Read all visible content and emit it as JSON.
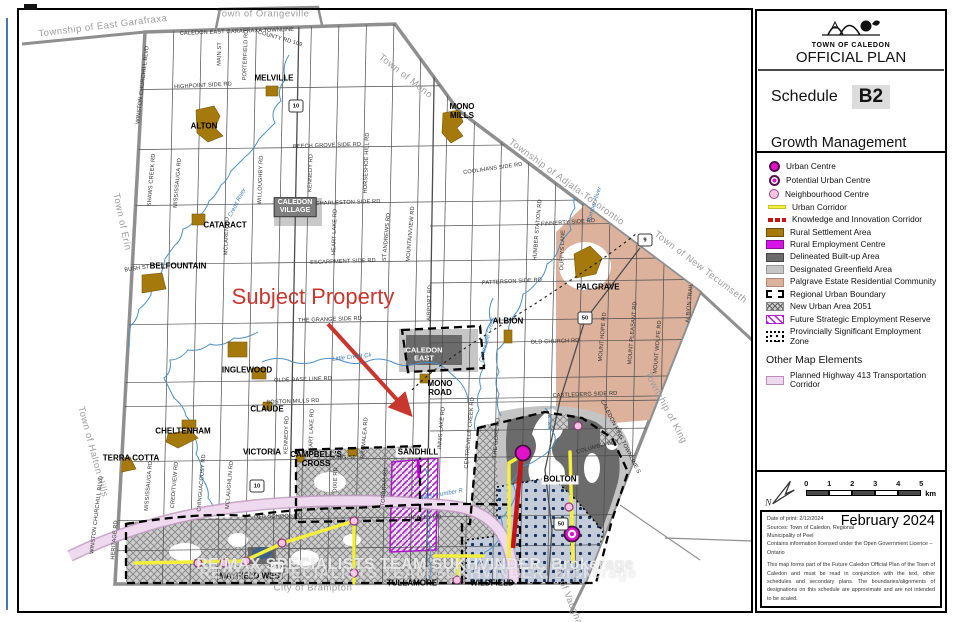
{
  "title_block": {
    "org": "TOWN OF CALEDON",
    "plan": "OFFICIAL PLAN",
    "schedule_label": "Schedule",
    "schedule_code": "B2",
    "subtitle": "Growth Management"
  },
  "legend": {
    "items": [
      {
        "label": "Urban Centre",
        "swatch": "uc"
      },
      {
        "label": "Potential Urban Centre",
        "swatch": "puc"
      },
      {
        "label": "Neighbourhood Centre",
        "swatch": "nc"
      },
      {
        "label": "Urban Corridor",
        "swatch": "ycorr"
      },
      {
        "label": "Knowledge and Innovation Corridor",
        "swatch": "kic"
      },
      {
        "label": "Rural Settlement Area",
        "swatch": "rsa"
      },
      {
        "label": "Rural Employment Centre",
        "swatch": "rec"
      },
      {
        "label": "Delineated Built-up Area",
        "swatch": "dba"
      },
      {
        "label": "Designated Greenfield Area",
        "swatch": "dga"
      },
      {
        "label": "Palgrave Estate Residential Community",
        "swatch": "perc"
      },
      {
        "label": "Regional Urban Boundary",
        "swatch": "rub"
      },
      {
        "label": "New Urban Area 2051",
        "swatch": "nua"
      },
      {
        "label": "Future Strategic Employment Reserve",
        "swatch": "fser"
      },
      {
        "label": "Provincially Significant Employment Zone",
        "swatch": "psez"
      }
    ],
    "other_header": "Other Map Elements",
    "other_items": [
      {
        "label": "Planned Highway 413 Transportation Corridor",
        "swatch": "h413"
      }
    ]
  },
  "scale": {
    "ticks": [
      "0",
      "1",
      "2",
      "3",
      "4",
      "5"
    ],
    "unit": "km",
    "north": "N"
  },
  "notes": {
    "month": "February 2024",
    "date_of_print": "Date of print: 2/12/2024",
    "sources": "Sources: Town of Caledon, Regional Municipality of Peel",
    "licence": "Contains information licensed under the Open Government Licence – Ontario",
    "disclaimer": "This map forms part of the Future Caledon Official Plan of the Town of Caledon and must be read in conjunction with the text, other schedules and secondary plans. The boundaries/alignments of designations on this schedule are approximate and are not intended to be scaled."
  },
  "map": {
    "subject_property": {
      "text": "Subject Property",
      "x": 313,
      "y": 297
    },
    "watermark": "RE/MAX SPECIALISTS TEAM SUKHVINDER, Brokerage",
    "colors": {
      "urban_centre": "#e013c8",
      "neighbourhood": "#f6c3e3",
      "rural_settlement": "#a5790c",
      "built_up": "#6b6b6b",
      "greenfield": "#c6c6c6",
      "palgrave_estate": "#dcb29c",
      "corridor_yellow": "#f3ef3c",
      "corridor_red": "#c41414",
      "hwy413_pink": "#eed9ee",
      "water": "#4d8fc4",
      "subject_red": "#c8372d"
    },
    "labels": [
      [
        "Township of East Garafraxa",
        103,
        27,
        -7,
        "bound"
      ],
      [
        "Town of Orangeville",
        263,
        15,
        0,
        "bound"
      ],
      [
        "Town of Mono",
        405,
        77,
        38,
        "bound"
      ],
      [
        "Township of Adjala-Tosorontio",
        566,
        183,
        36,
        "bound"
      ],
      [
        "Town of New Tecumseth",
        700,
        268,
        37,
        "bound"
      ],
      [
        "Township of King",
        665,
        408,
        62,
        "bound"
      ],
      [
        "City of Vaughan",
        567,
        596,
        68,
        "bound"
      ],
      [
        "Town of Erin",
        121,
        222,
        78,
        "bound"
      ],
      [
        "Town of Halton Hills",
        92,
        452,
        75,
        "bound"
      ],
      [
        "City of Brampton",
        313,
        589,
        0,
        "bound"
      ],
      [
        "ALTON",
        204,
        127,
        0,
        "set"
      ],
      [
        "MELVILLE",
        274,
        79,
        0,
        "set"
      ],
      [
        "MONO\nMILLS",
        462,
        112,
        0,
        "set"
      ],
      [
        "CATARACT",
        225,
        226,
        0,
        "set"
      ],
      [
        "BELFOUNTAIN",
        178,
        267,
        0,
        "set"
      ],
      [
        "INGLEWOOD",
        247,
        371,
        0,
        "set"
      ],
      [
        "CLAUDE",
        267,
        410,
        0,
        "set"
      ],
      [
        "CHELTENHAM",
        183,
        432,
        0,
        "set"
      ],
      [
        "TERRA COTTA",
        131,
        459,
        0,
        "set"
      ],
      [
        "VICTORIA",
        262,
        453,
        0,
        "set"
      ],
      [
        "CAMPBELL'S\nCROSS",
        316,
        460,
        0,
        "set"
      ],
      [
        "SANDHILL",
        418,
        453,
        0,
        "chip"
      ],
      [
        "PALGRAVE",
        598,
        288,
        0,
        "set"
      ],
      [
        "ALBION",
        508,
        322,
        0,
        "set"
      ],
      [
        "MONO\nROAD",
        440,
        389,
        0,
        "set"
      ],
      [
        "BOLTON",
        560,
        480,
        0,
        "chip"
      ],
      [
        "MAYFIELD WEST",
        252,
        577,
        0,
        "set"
      ],
      [
        "TULLAMORE",
        412,
        584,
        0,
        "set"
      ],
      [
        "WILDFIELD",
        492,
        584,
        0,
        "set"
      ],
      [
        "CALEDON\nVILLAGE",
        295,
        207,
        0,
        "box"
      ],
      [
        "CALEDON\nEAST",
        424,
        355,
        0,
        "white"
      ],
      [
        "CALEDON EAST GARAFRAXA TOWNLINE",
        237,
        32,
        -2,
        "road"
      ],
      [
        "COUNTY RD 109",
        280,
        39,
        16,
        "road"
      ],
      [
        "HIGHPOINT SIDE RD",
        203,
        86,
        -3,
        "road"
      ],
      [
        "BEECH GROVE SIDE RD",
        327,
        146,
        -2,
        "road"
      ],
      [
        "CHARLESTON SIDE RD",
        348,
        203,
        -2,
        "road"
      ],
      [
        "COOLIHANS SIDE RD",
        493,
        169,
        -8,
        "road"
      ],
      [
        "ESCARPMENT SIDE RD",
        343,
        262,
        -2,
        "road"
      ],
      [
        "FINNERTY SIDE RD",
        568,
        223,
        -4,
        "road"
      ],
      [
        "PATTERSON SIDE RD",
        512,
        282,
        -3,
        "road"
      ],
      [
        "THE GRANGE SIDE RD",
        330,
        320,
        -2,
        "road"
      ],
      [
        "OLDE BASE LINE RD",
        303,
        380,
        -2,
        "road"
      ],
      [
        "BOSTON MILLS RD",
        293,
        402,
        -2,
        "road"
      ],
      [
        "OLD CHURCH RD",
        555,
        342,
        -2,
        "road"
      ],
      [
        "CASTLEDERG SIDE RD",
        585,
        395,
        -2,
        "road"
      ],
      [
        "OLD SCHOOL RD",
        278,
        517,
        -1,
        "road"
      ],
      [
        "HEALEY RD",
        425,
        518,
        -2,
        "road"
      ],
      [
        "KING ST",
        344,
        458,
        0,
        "road"
      ],
      [
        "BUSH ST",
        137,
        269,
        -8,
        "road"
      ],
      [
        "WINSTON CHURCHILL BLVD",
        143,
        85,
        -83,
        "road"
      ],
      [
        "WINSTON CHURCHILL BLVD",
        97,
        515,
        -83,
        "road"
      ],
      [
        "MAIN ST",
        220,
        54,
        -88,
        "road"
      ],
      [
        "PORTERFIELD RD",
        246,
        55,
        -88,
        "road"
      ],
      [
        "SHAWS CREEK RD",
        152,
        180,
        -85,
        "road"
      ],
      [
        "MISSISSAUGA RD",
        178,
        183,
        -85,
        "road"
      ],
      [
        "WILLOUGHBY RD",
        261,
        180,
        -88,
        "road"
      ],
      [
        "KENNEDY RD",
        311,
        173,
        -88,
        "road"
      ],
      [
        "HORSESHOE HILL RD",
        367,
        163,
        -88,
        "road"
      ],
      [
        "HEART LAKE RD",
        335,
        232,
        -88,
        "road"
      ],
      [
        "ST ANDREWS RD",
        387,
        237,
        -85,
        "road"
      ],
      [
        "MOUNTAINVIEW RD",
        411,
        234,
        -85,
        "road"
      ],
      [
        "MCLAREN RD",
        227,
        236,
        -88,
        "road"
      ],
      [
        "AIRPORT RD",
        430,
        303,
        -88,
        "road"
      ],
      [
        "HUMBER STATION RD",
        538,
        230,
        -85,
        "road"
      ],
      [
        "DUFFYS LANE",
        563,
        250,
        -88,
        "road"
      ],
      [
        "MOUNT HOPE RD",
        603,
        337,
        -85,
        "road"
      ],
      [
        "MOUNT PLEASANT RD",
        633,
        333,
        -85,
        "road"
      ],
      [
        "MOUNT WOLFE RD",
        658,
        347,
        -85,
        "road"
      ],
      [
        "ALBION TRAIL",
        690,
        303,
        -85,
        "road"
      ],
      [
        "HERITAGE RD",
        115,
        540,
        -85,
        "road"
      ],
      [
        "MISSISSAUGA RD",
        149,
        486,
        -85,
        "road"
      ],
      [
        "CREDITVIEW RD",
        175,
        485,
        -85,
        "road"
      ],
      [
        "CHINGUACOUSY RD",
        202,
        483,
        -85,
        "road"
      ],
      [
        "MCLAUGHLIN RD",
        230,
        485,
        -85,
        "road"
      ],
      [
        "KENNEDY RD",
        287,
        435,
        -88,
        "road"
      ],
      [
        "HEART LAKE RD",
        312,
        432,
        -88,
        "road"
      ],
      [
        "DIXIE RD",
        336,
        480,
        -88,
        "road"
      ],
      [
        "BRAMALEA RD",
        365,
        438,
        -85,
        "road"
      ],
      [
        "TORBRAM RD",
        385,
        487,
        -85,
        "road"
      ],
      [
        "INNIS LAKE RD",
        442,
        428,
        -85,
        "road"
      ],
      [
        "CENTREVILLE CREEK RD",
        470,
        433,
        -85,
        "road"
      ],
      [
        "THE GORE RD",
        497,
        438,
        -85,
        "road"
      ],
      [
        "CALEDON KING TOWNLINE S",
        620,
        437,
        63,
        "road"
      ],
      [
        "COLUMBIA WAY",
        598,
        447,
        -15,
        "road"
      ],
      [
        "Credit River",
        238,
        203,
        -62,
        "river"
      ],
      [
        "Humber River",
        595,
        205,
        -72,
        "river"
      ],
      [
        "Little Credit Ck",
        352,
        358,
        -6,
        "river"
      ],
      [
        "Centreville Creek",
        488,
        340,
        -75,
        "river"
      ],
      [
        "West Humber R",
        442,
        495,
        -10,
        "river"
      ]
    ],
    "shields": [
      [
        "10",
        296,
        106
      ],
      [
        "10",
        257,
        486
      ],
      [
        "9",
        645,
        240
      ],
      [
        "50",
        585,
        318
      ],
      [
        "50",
        561,
        524
      ],
      [
        "410",
        277,
        567
      ]
    ],
    "markers": {
      "urban_centre": [
        [
          523,
          453
        ]
      ],
      "potential_urban_centre": [
        [
          572,
          534
        ]
      ],
      "neighbourhood_centre": [
        [
          198,
          563
        ],
        [
          224,
          563
        ],
        [
          246,
          561
        ],
        [
          282,
          543
        ],
        [
          354,
          521
        ],
        [
          354,
          573
        ],
        [
          457,
          580
        ],
        [
          578,
          426
        ],
        [
          569,
          507
        ]
      ]
    }
  }
}
